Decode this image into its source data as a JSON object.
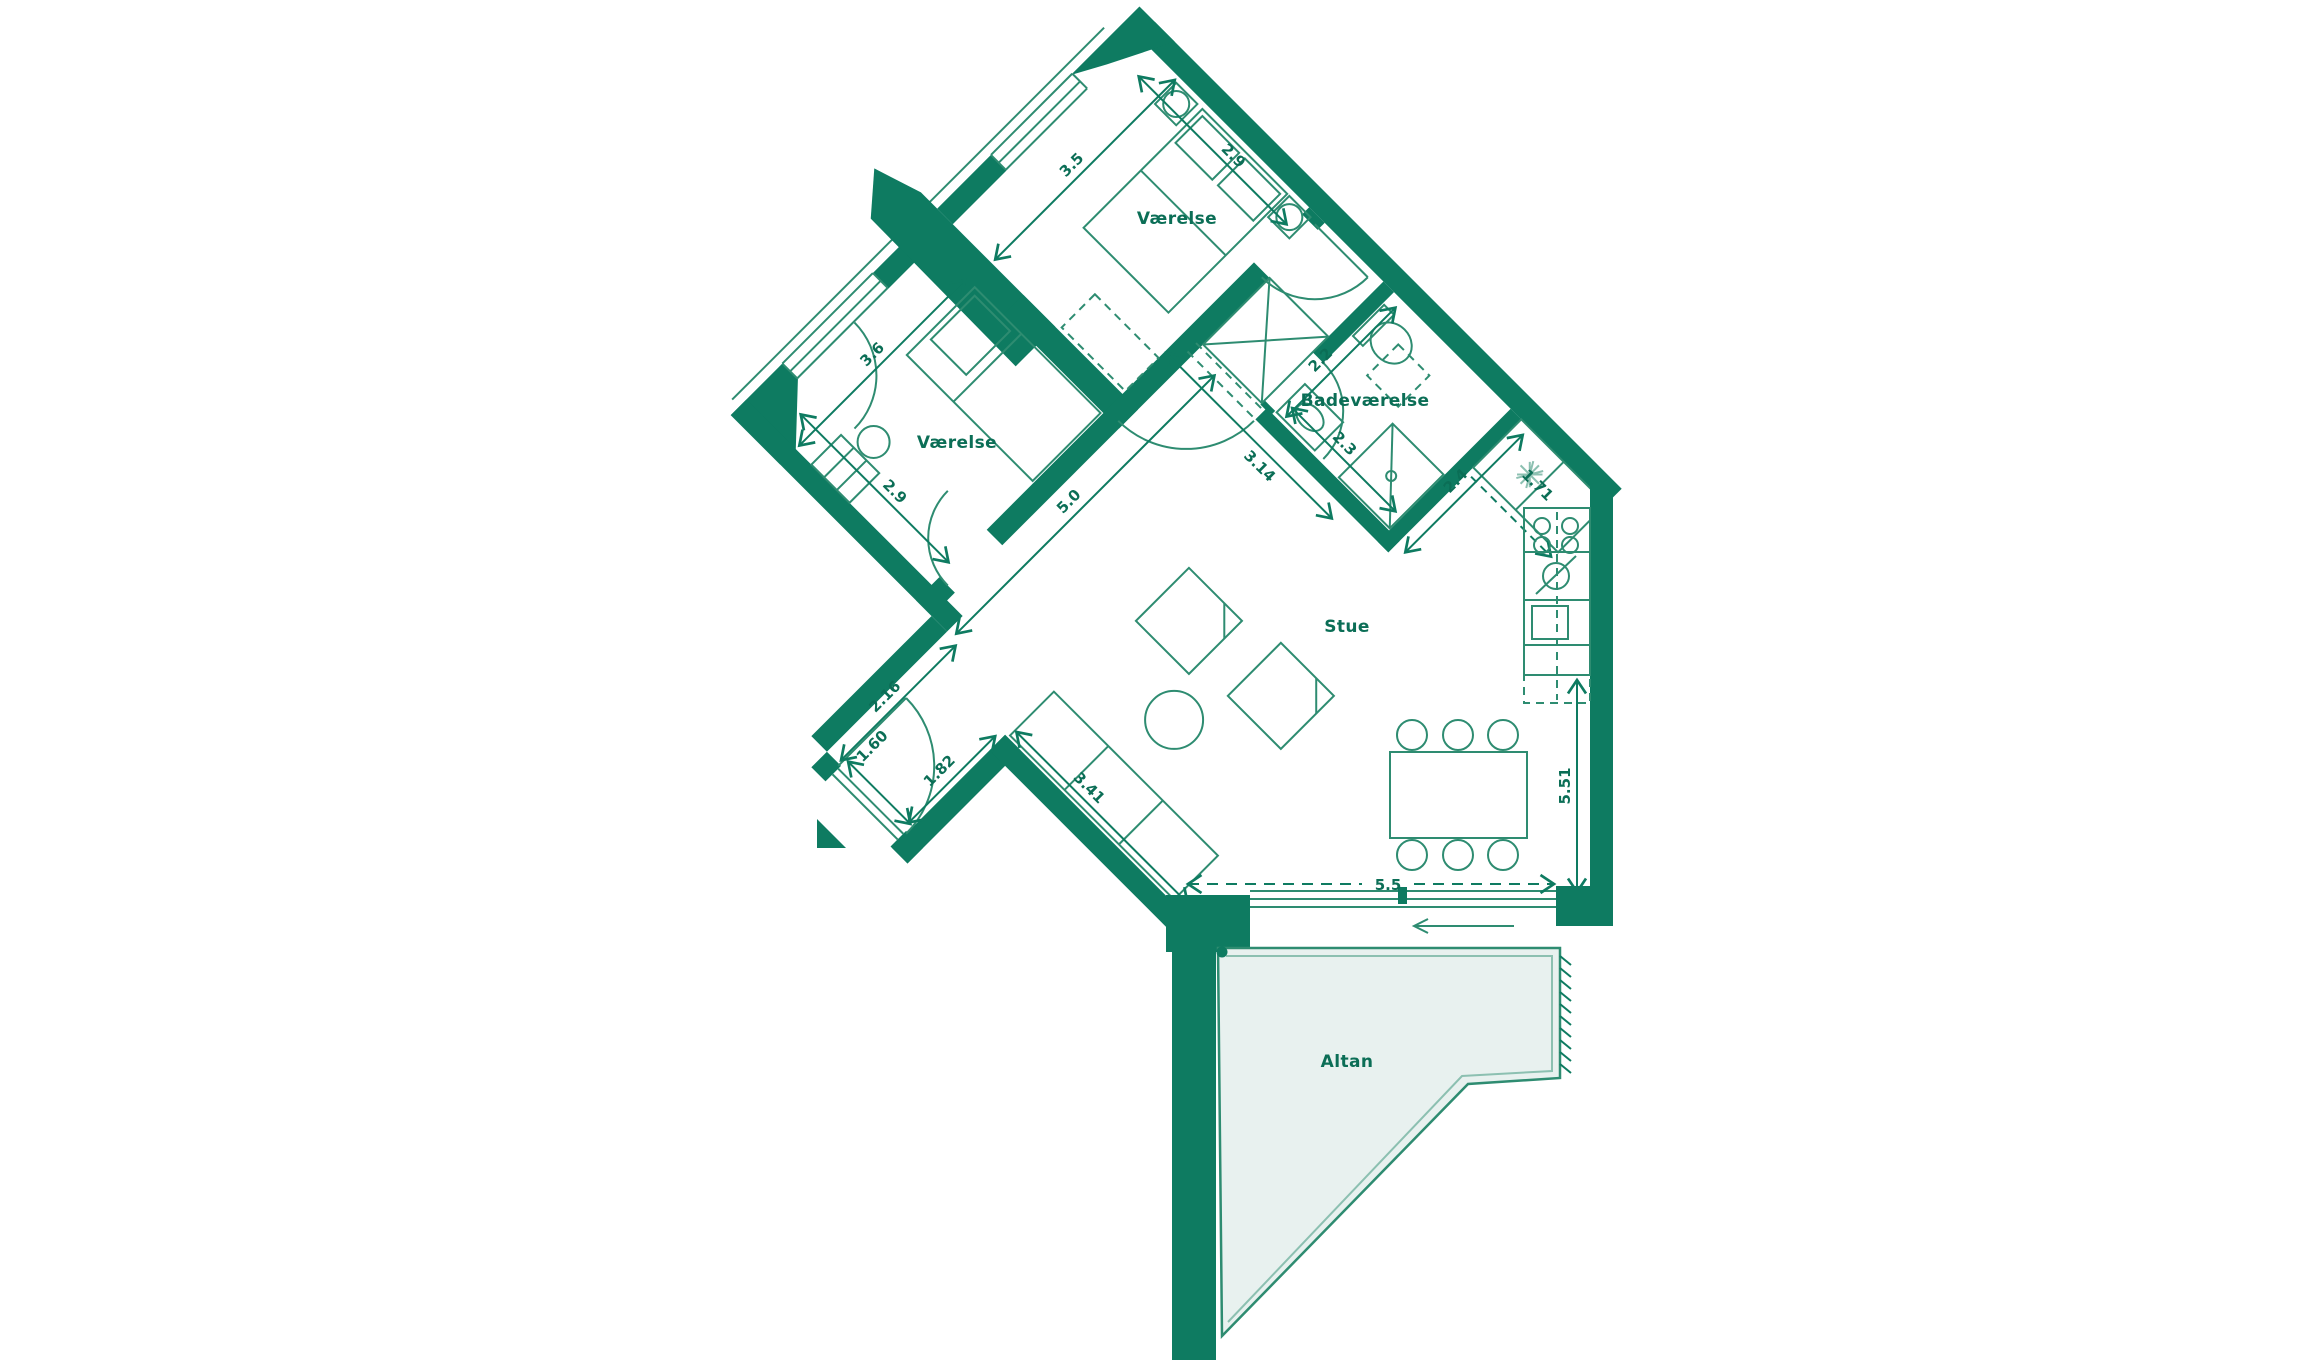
{
  "plan": {
    "title": "apartment-floor-plan",
    "rooms": {
      "bedroom_top": "Værelse",
      "bedroom_left": "Værelse",
      "bathroom": "Badeværelse",
      "living_room": "Stue",
      "balcony": "Altan"
    },
    "dimensions": {
      "bedroom_top_length": "3.5",
      "bedroom_top_width": "2.9",
      "bedroom_left_length": "3.6",
      "bedroom_left_width": "2.9",
      "living_diagonal": "5.0",
      "hall_wall": "2.16",
      "entrance_door": "1.60",
      "hall_opening": "1.82",
      "sofa_wall": "3.41",
      "living_width": "5.5",
      "living_height": "5.51",
      "bath_width": "2.2",
      "bath_length": "2.3",
      "bath_face": "3.14",
      "kitchen_face": "2.4",
      "kitchen_diagonal": "1.71"
    },
    "colors": {
      "wall": "#0e7b61",
      "line": "#2e8c71",
      "light": "#8cc0b1",
      "fill": "#e8f1ef",
      "text": "#0b6e56"
    }
  }
}
